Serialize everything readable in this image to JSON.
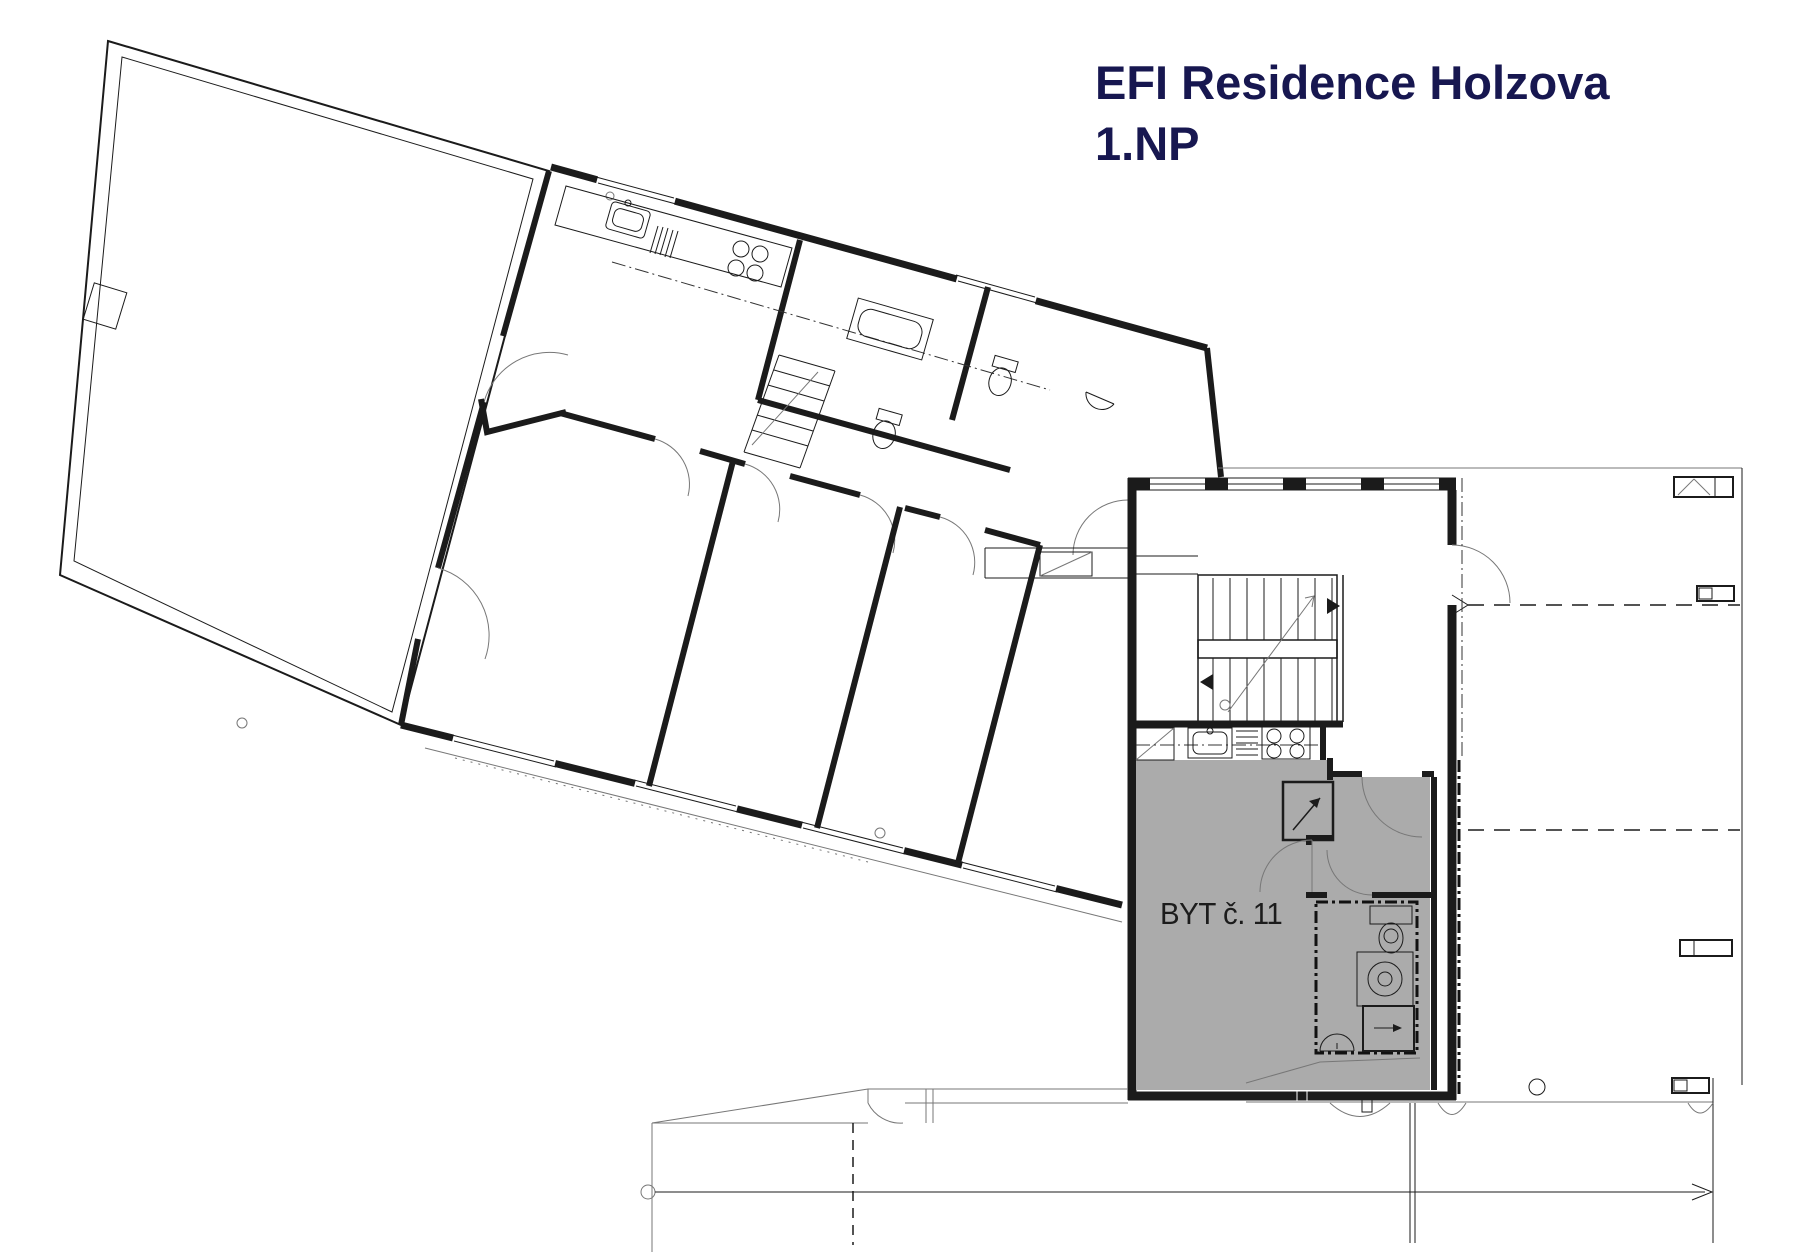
{
  "title": {
    "line1": "EFI Residence Holzova",
    "line2": "1.NP"
  },
  "apartment": {
    "label": "BYT č. 11",
    "status": "highlighted"
  },
  "colors": {
    "title_text": "#171750",
    "unit_highlight": "#ABABAB",
    "walls": "#1b1b1b",
    "background": "#ffffff"
  }
}
